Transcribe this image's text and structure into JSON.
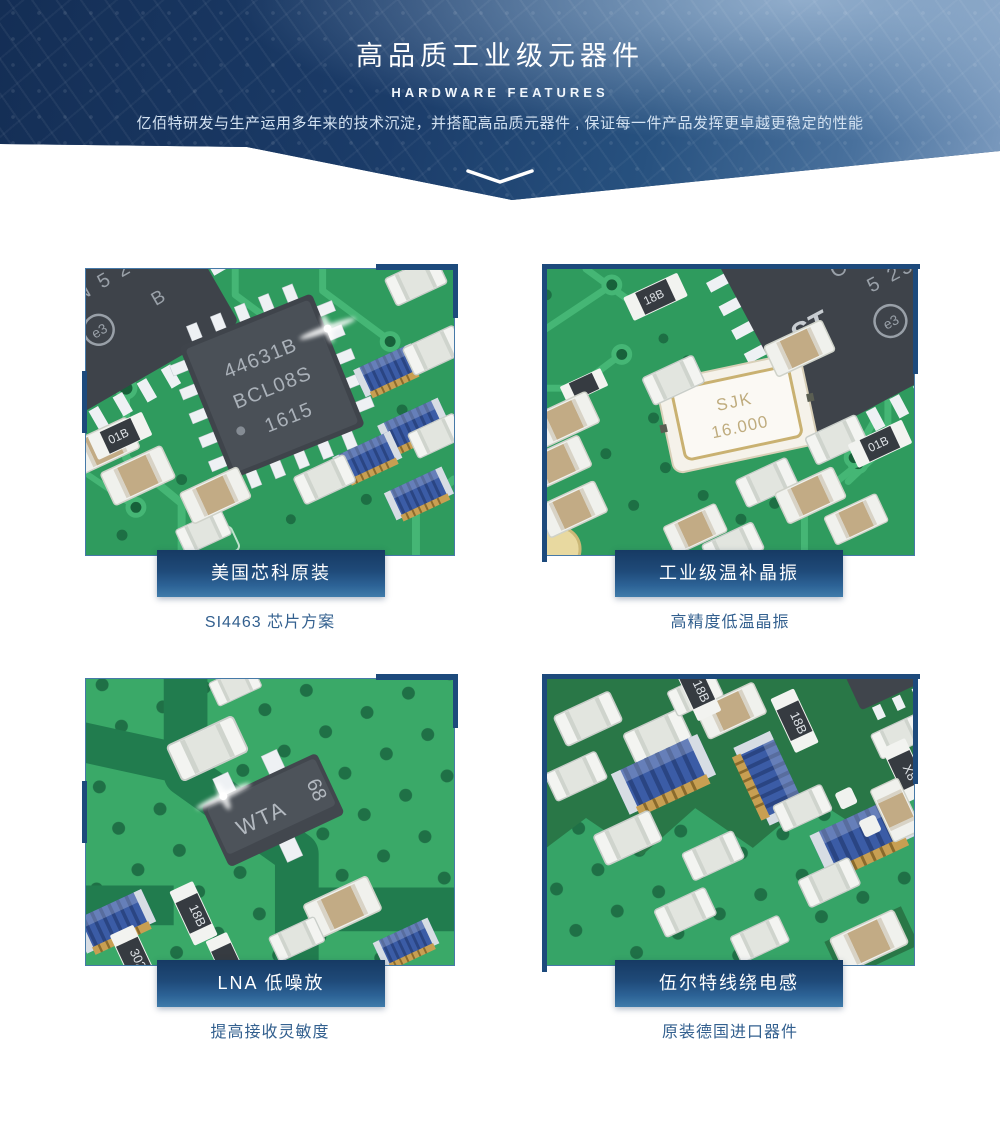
{
  "banner": {
    "title": "高品质工业级元器件",
    "subtitle": "HARDWARE FEATURES",
    "description": "亿佰特研发与生产运用多年来的技术沉淀，并搭配高品质元器件 , 保证每一件产品发挥更卓越更稳定的性能"
  },
  "features": [
    {
      "badge": "美国芯科原装",
      "caption": "SI4463 芯片方案",
      "labels": {
        "chip1": "44631B",
        "chip2": "BCL08S",
        "chip3": "1615",
        "corner1": "1Q9U",
        "corner2": "N 5 23",
        "corner3": "B",
        "logo": "e3",
        "res1": "01B"
      }
    },
    {
      "badge": "工业级温补晶振",
      "caption": "高精度低温晶振",
      "labels": {
        "xtal1": "SJK",
        "xtal2": "16.000",
        "chip1": "CHN",
        "chip2": "5 23",
        "chip3": "B",
        "logo": "e3",
        "st": "ST",
        "res1": "18B",
        "res2": "01B"
      }
    },
    {
      "badge": "LNA 低噪放",
      "caption": "提高接收灵敏度",
      "labels": {
        "sot1": "WTA",
        "sot2": "68",
        "res1": "18B",
        "res2": "302"
      }
    },
    {
      "badge": "伍尔特线绕电感",
      "caption": "原装德国进口器件",
      "labels": {
        "res1": "18B",
        "res2": "18B",
        "res3": "X8"
      }
    }
  ],
  "colors": {
    "accent_navy": "#1d4a7c",
    "badge_gradient_top": "#163a63",
    "badge_gradient_bottom": "#3f7cab",
    "caption_text": "#33608f",
    "pcb_green": "#2f9b5e",
    "banner_navy": "#1b3a66"
  }
}
